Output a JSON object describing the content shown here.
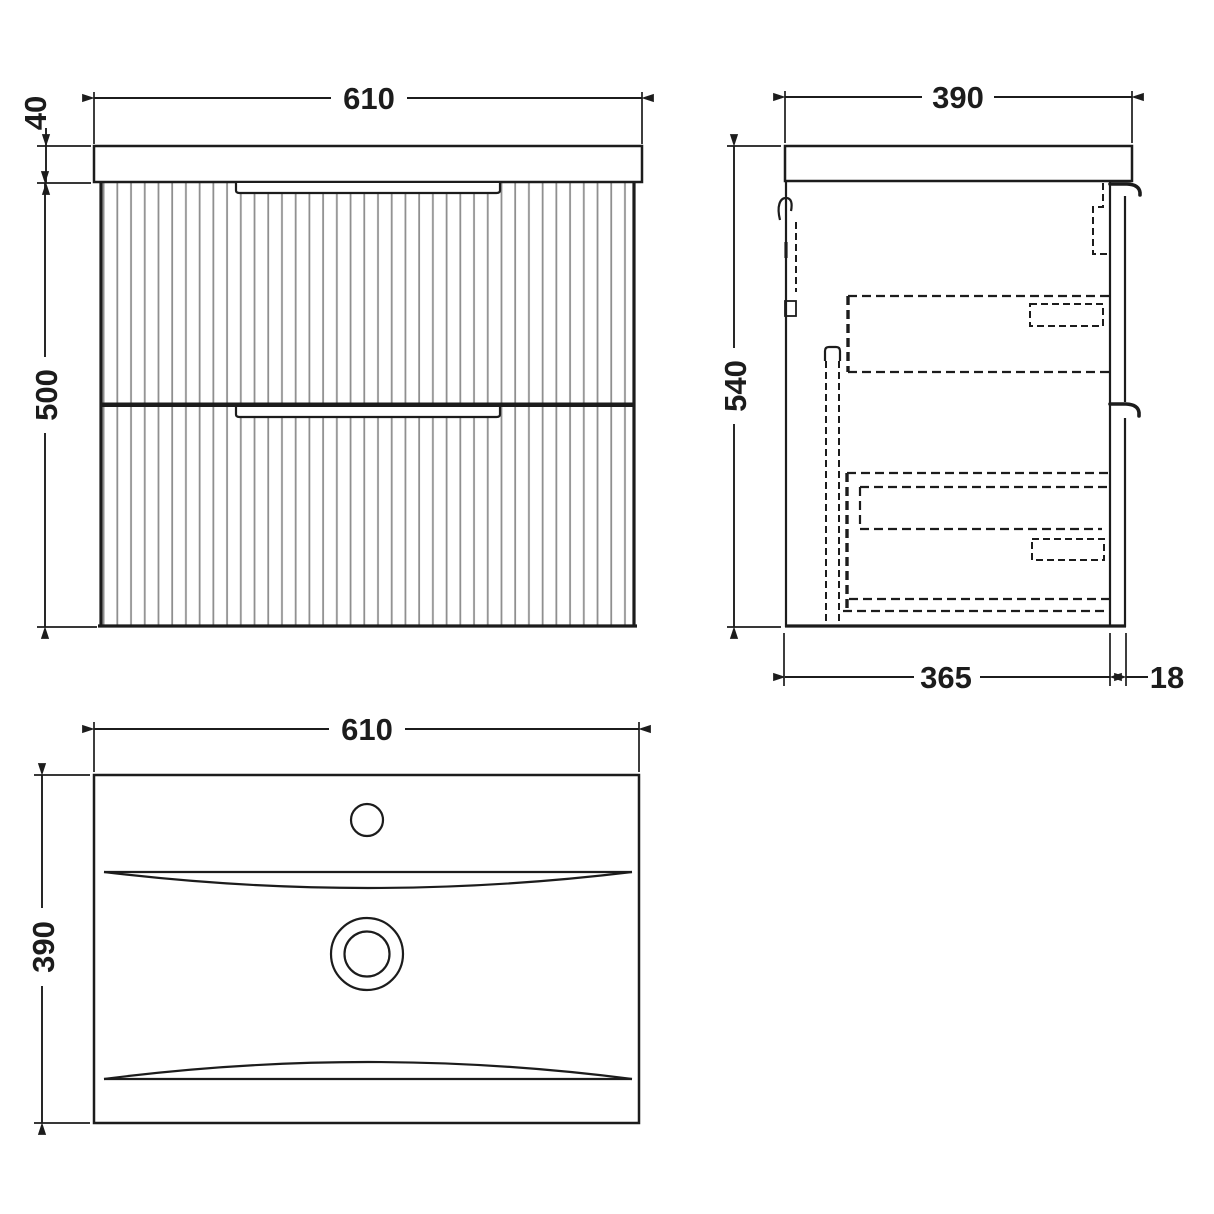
{
  "dims": {
    "front_width": "610",
    "front_worktop_thickness": "40",
    "front_cabinet_height": "500",
    "side_overall_depth": "390",
    "side_overall_height": "540",
    "side_body_depth": "365",
    "side_front_thickness": "18",
    "plan_width": "610",
    "plan_depth": "390"
  },
  "colors": {
    "line": "#1c1c1c",
    "flute": "#8f8f8f",
    "background": "#ffffff"
  }
}
